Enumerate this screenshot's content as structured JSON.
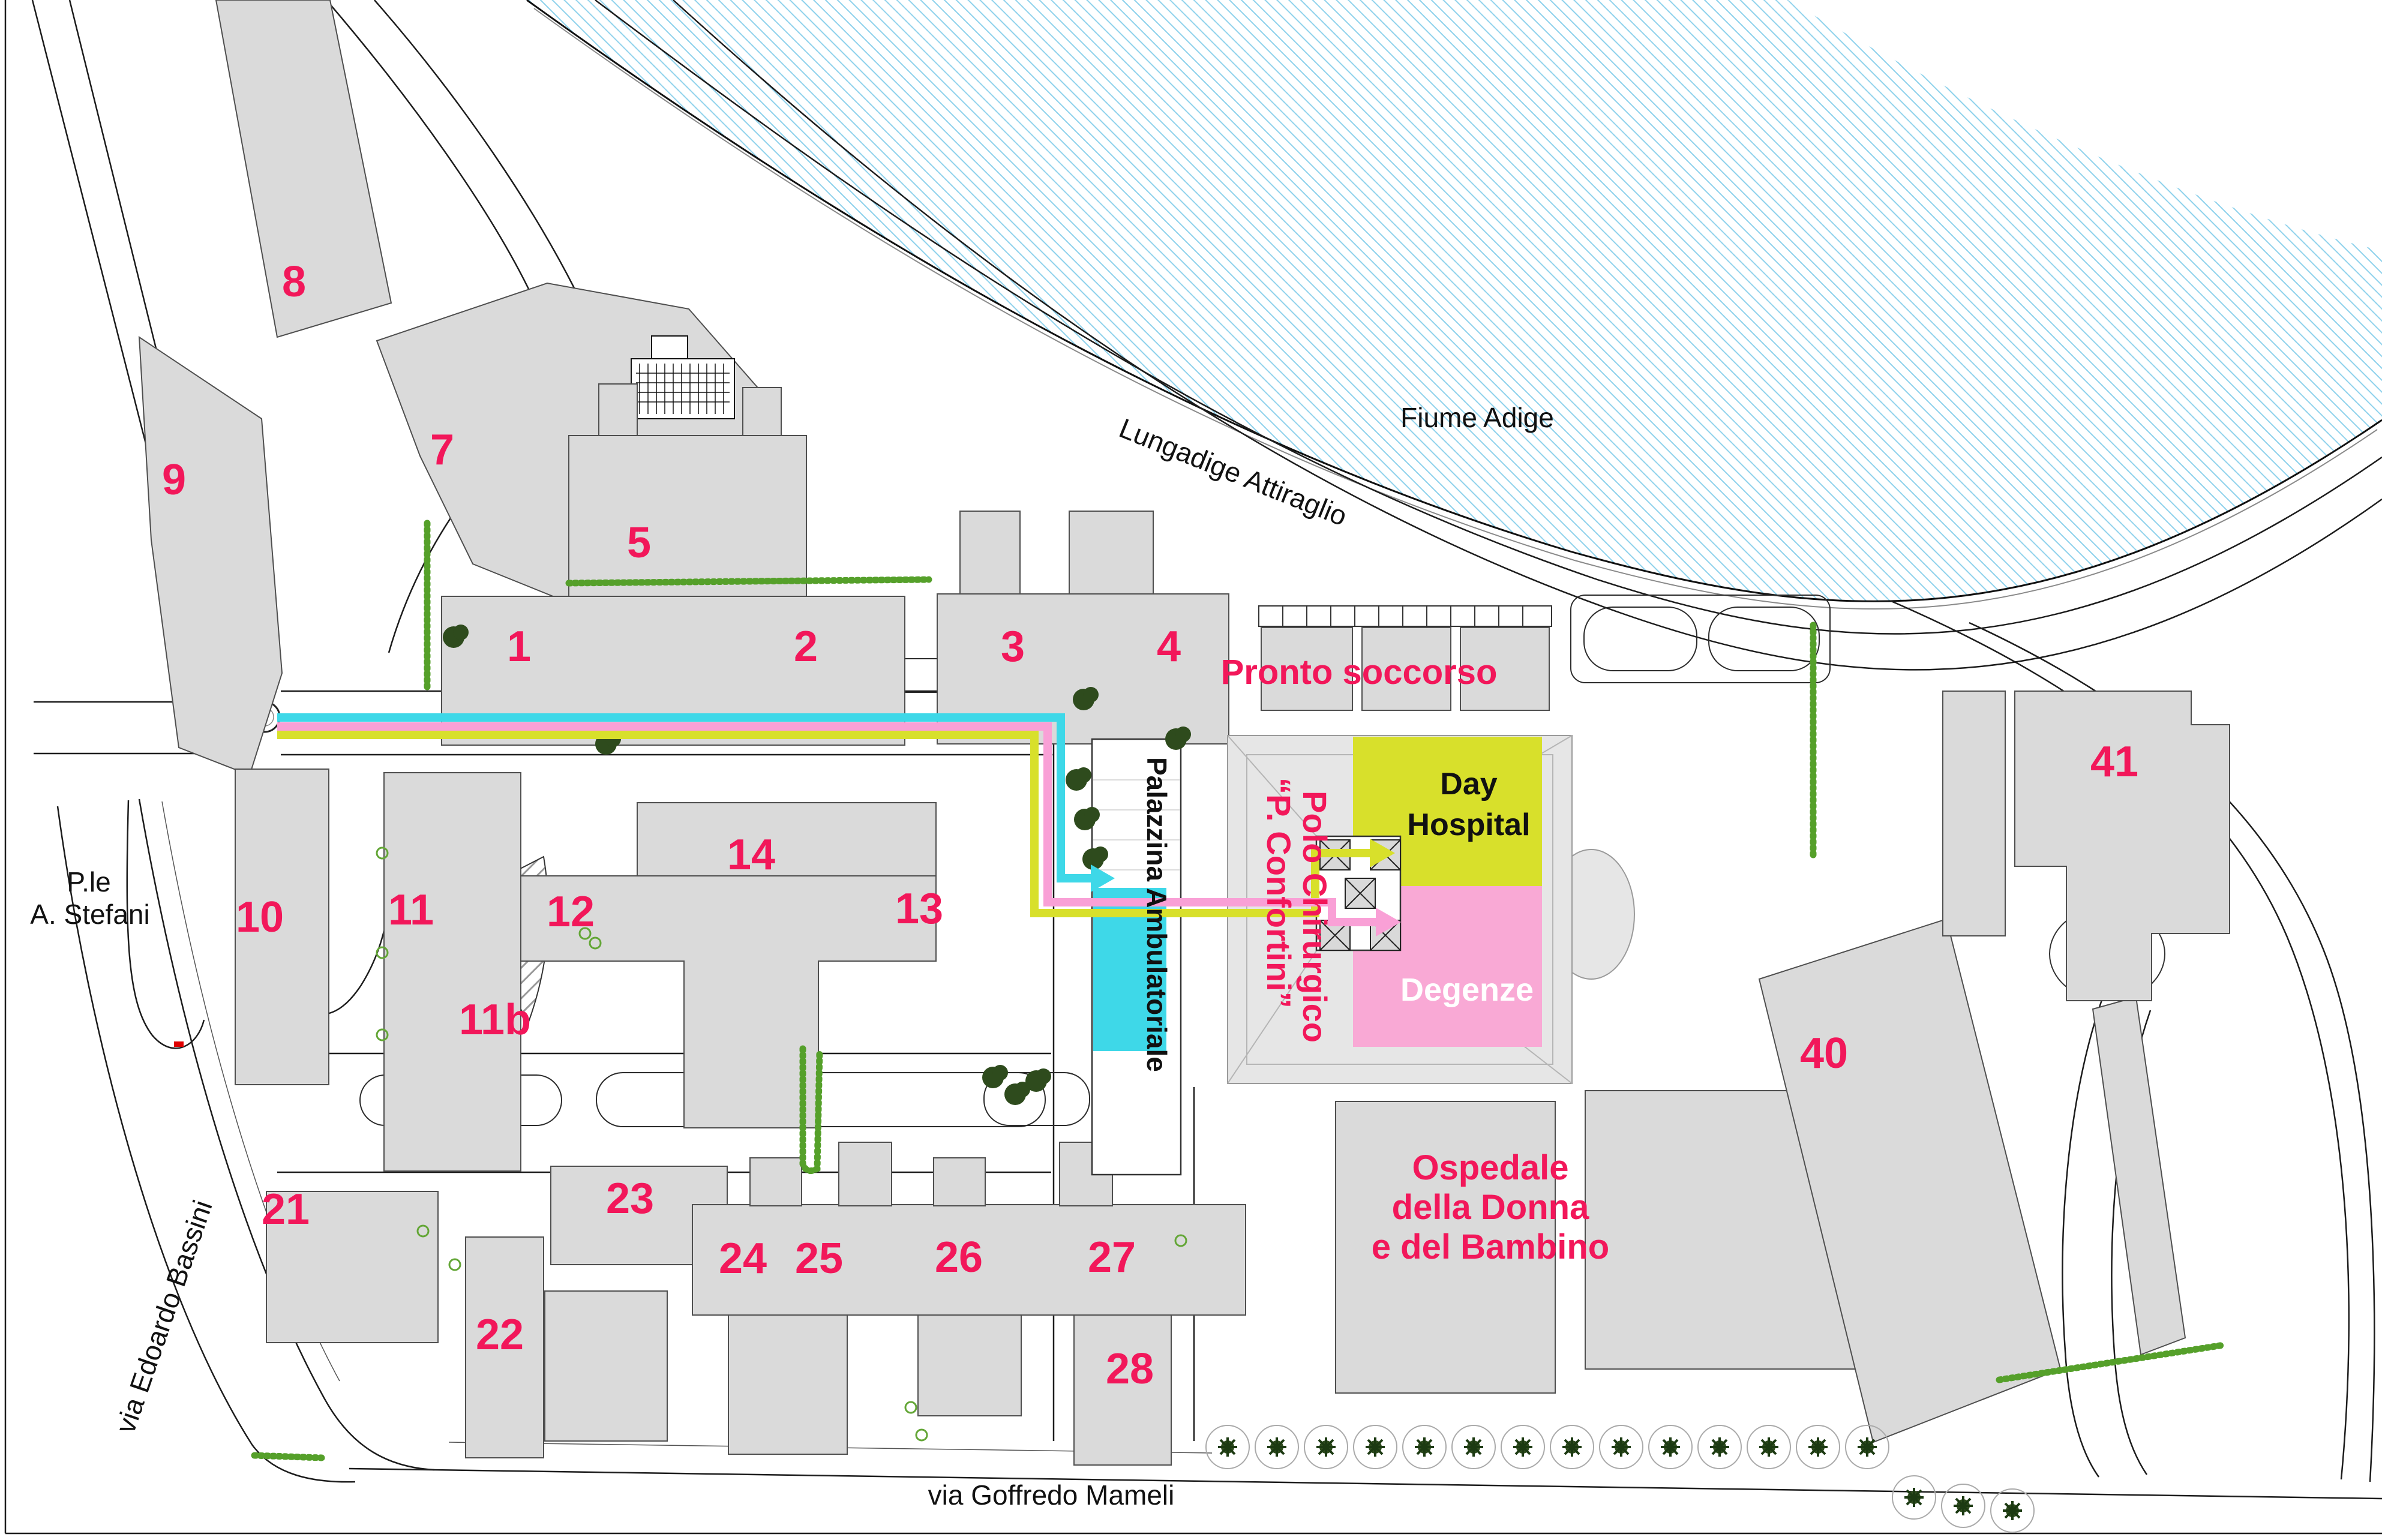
{
  "labels": {
    "river": "Fiume Adige",
    "lungadige": "Lungadige Attiraglio",
    "mameli": "via Goffredo Mameli",
    "bassini": "via Edoardo Bassini",
    "stefani_l1": "P.le",
    "stefani_l2": "A. Stefani",
    "pronto_soccorso": "Pronto soccorso",
    "day_hospital_l1": "Day",
    "day_hospital_l2": "Hospital",
    "degenze": "Degenze",
    "polo_l1": "Polo Chirurgico",
    "polo_l2": "“P. Confortini”",
    "palazzina": "Palazzina Ambulatoriale",
    "ospedale_l1": "Ospedale",
    "ospedale_l2": "della Donna",
    "ospedale_l3": "e del Bambino"
  },
  "buildings": [
    {
      "label": "1"
    },
    {
      "label": "2"
    },
    {
      "label": "3"
    },
    {
      "label": "4"
    },
    {
      "label": "5"
    },
    {
      "label": "7"
    },
    {
      "label": "8"
    },
    {
      "label": "9"
    },
    {
      "label": "10"
    },
    {
      "label": "11"
    },
    {
      "label": "11b"
    },
    {
      "label": "12"
    },
    {
      "label": "13"
    },
    {
      "label": "14"
    },
    {
      "label": "21"
    },
    {
      "label": "22"
    },
    {
      "label": "23"
    },
    {
      "label": "24"
    },
    {
      "label": "25"
    },
    {
      "label": "26"
    },
    {
      "label": "27"
    },
    {
      "label": "28"
    },
    {
      "label": "40"
    },
    {
      "label": "41"
    }
  ],
  "colors": {
    "accent_crimson": "#F2175A",
    "route_cyan": "#3ED8E8",
    "route_pink": "#F9A0D6",
    "route_yellow": "#D8E02B",
    "area_day_hospital": "#D8E02B",
    "area_degenze": "#F9A9D5",
    "area_palazzina": "#3ED8E8",
    "building_fill": "#DADADA",
    "river_hatch": "#8FD2EC",
    "vegetation_green": "#55A02A"
  }
}
